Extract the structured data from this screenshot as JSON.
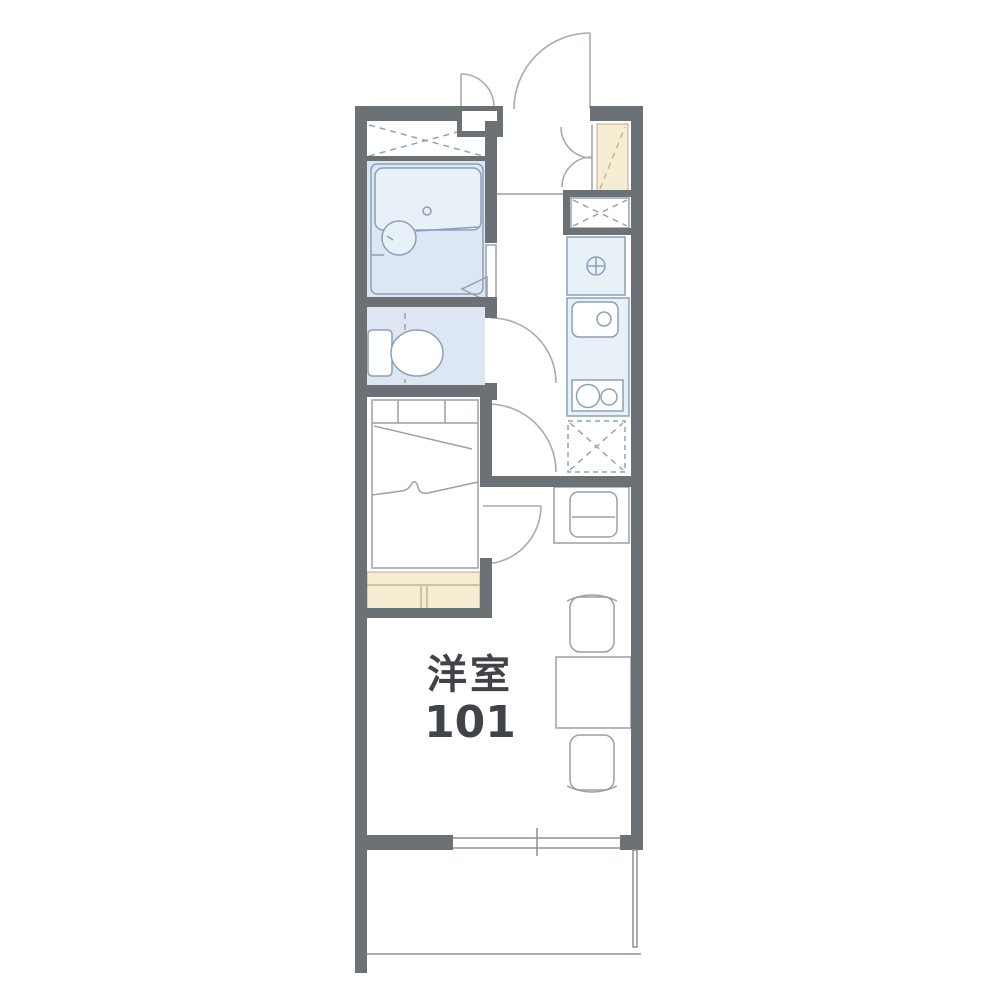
{
  "floorplan": {
    "type": "apartment-floor-plan",
    "room_label": {
      "line1": "洋室",
      "line2": "101"
    },
    "colors": {
      "wall": "#6c7176",
      "water-fill": "#dce7f3",
      "water-fill-light": "#e9f1f8",
      "fixture-stroke": "#8ba0b6",
      "furniture-stroke": "#9aa1a8",
      "door-stroke": "#a6acb3",
      "accent-cream": "#f6ecd1",
      "cream-stroke": "#b5ab90",
      "label-text": "#404449",
      "background": "#ffffff"
    },
    "fixtures": [
      "closet",
      "unit-bath",
      "bathtub",
      "wash-basin",
      "bath-folding-door",
      "toilet",
      "bed",
      "storage-counter",
      "entrance-door",
      "meter-box-door",
      "shoe-cabinet",
      "storage-box",
      "washing-machine-space",
      "kitchen-sink",
      "gas-stove",
      "refrigerator-space",
      "desk",
      "chair",
      "dining-table",
      "window",
      "balcony"
    ]
  }
}
